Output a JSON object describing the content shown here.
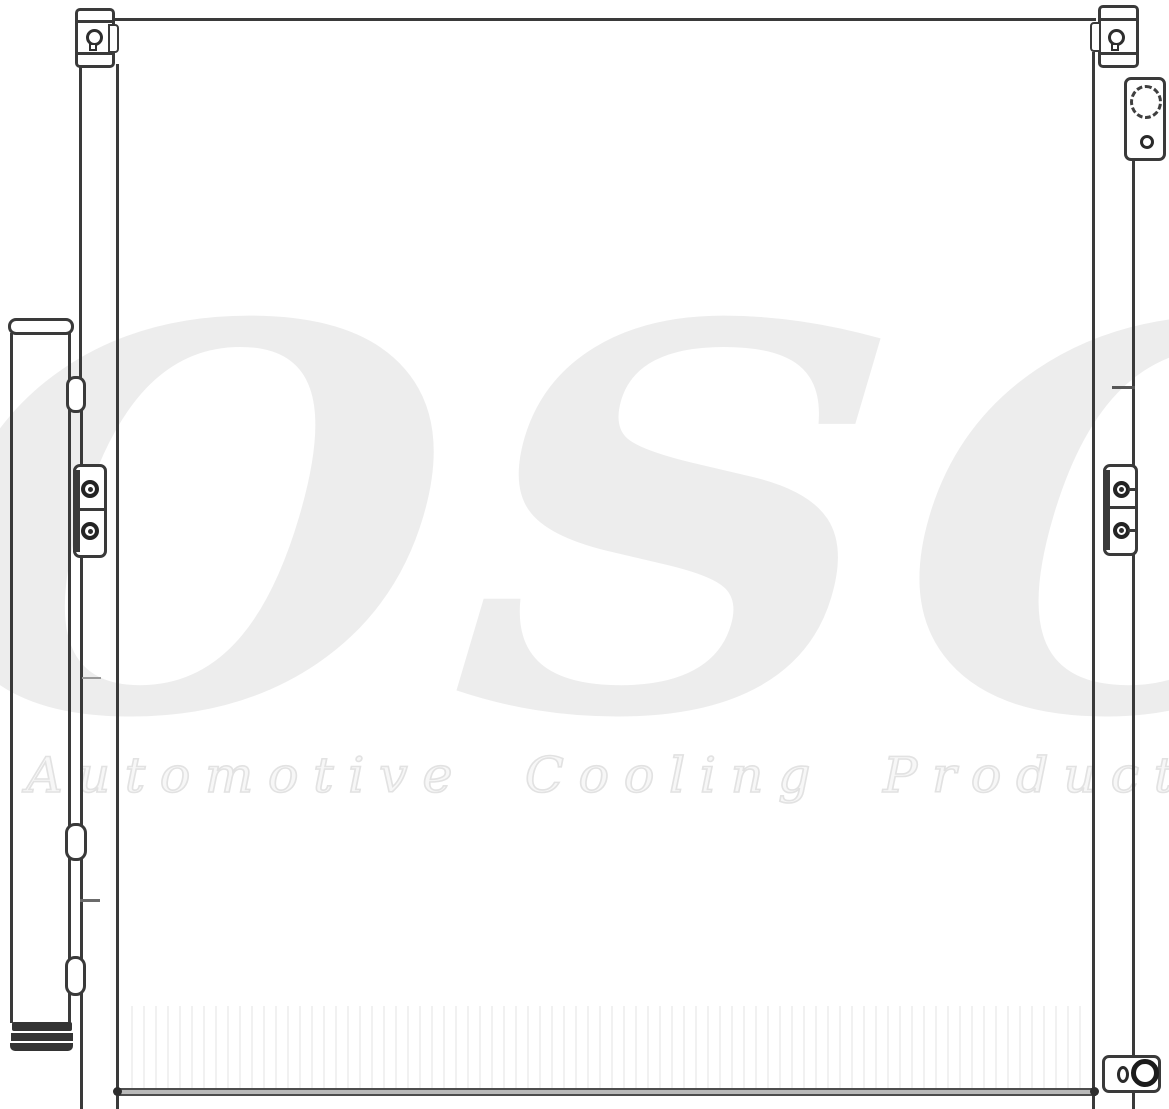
{
  "image": {
    "type": "technical-line-drawing",
    "subject": "automotive air conditioning condenser with integrated receiver drier, mounting brackets and refrigerant fittings",
    "background_color": "#ffffff",
    "line_color": "#3a3a3a"
  },
  "watermark": {
    "logo_text": "OSC",
    "tagline": "Automotive Cooling Products",
    "logo_color": "#ededed",
    "tagline_color": "#f7f7f7"
  }
}
